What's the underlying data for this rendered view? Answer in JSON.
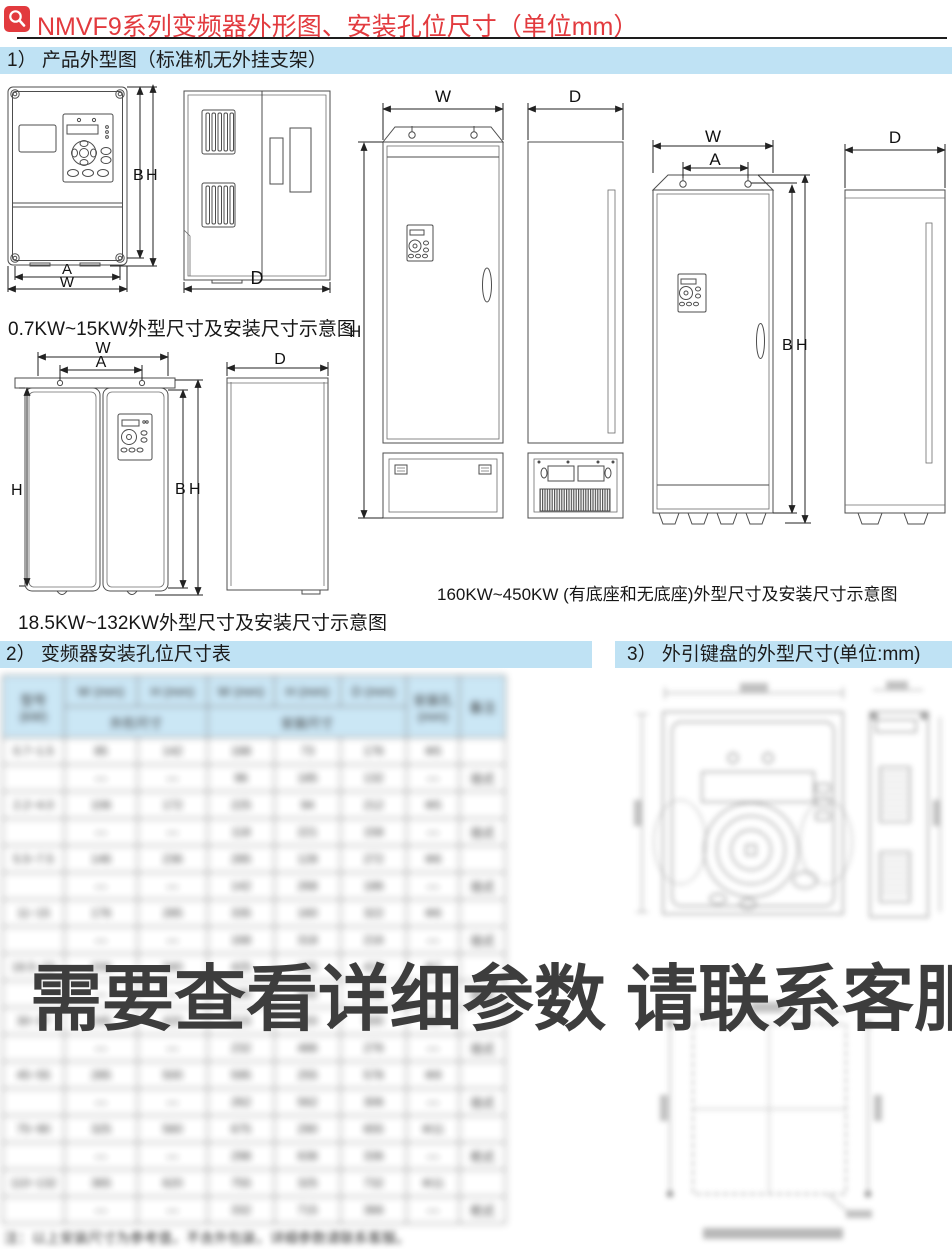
{
  "header": {
    "title": "NMVF9系列变频器外形图、安装孔位尺寸（单位mm）"
  },
  "sections": {
    "s1_heading": "1） 产品外型图（标准机无外挂支架）",
    "s2_heading": "2） 变频器安装孔位尺寸表",
    "s3_heading": "3） 外引键盘的外型尺寸(单位:mm)"
  },
  "captions": {
    "small_range": "0.7KW~15KW外型尺寸及安装尺寸示意图",
    "mid_range": "18.5KW~132KW外型尺寸及安装尺寸示意图",
    "large_range": "160KW~450KW (有底座和无底座)外型尺寸及安装尺寸示意图"
  },
  "dim_labels": {
    "w": "W",
    "a": "A",
    "b": "B",
    "h": "H",
    "d": "D"
  },
  "watermark": {
    "text": "需要查看详细参数 请联系客服"
  },
  "colors": {
    "accent_red": "#e23a3e",
    "banner_blue": "#bfe2f4",
    "table_header_blue": "#c7e5f5"
  },
  "mounting_table": {
    "illegible": true,
    "note": "table content is blurred beyond legibility in the source image; cells below are visual placeholders",
    "header": {
      "model": "型号",
      "model_unit": "(kW)",
      "c2": "W (mm)",
      "c3": "H (mm)",
      "c4": "W (mm)",
      "c5": "H (mm)",
      "c6": "D (mm)",
      "c7": "安装孔(mm)",
      "c8": "备注",
      "group_left": "外形尺寸",
      "group_right": "安装尺寸"
    },
    "placeholder_rows": [
      [
        "0.7~1.5",
        "85",
        "142",
        "188",
        "73",
        "176",
        "Φ5",
        ""
      ],
      [
        "",
        "—",
        "—",
        "96",
        "185",
        "132",
        "—",
        "挂式"
      ],
      [
        "2.2~4.0",
        "106",
        "172",
        "225",
        "94",
        "212",
        "Φ5",
        ""
      ],
      [
        "",
        "—",
        "—",
        "118",
        "221",
        "158",
        "—",
        "挂式"
      ],
      [
        "5.5~7.5",
        "146",
        "236",
        "285",
        "128",
        "272",
        "Φ6",
        ""
      ],
      [
        "",
        "—",
        "—",
        "142",
        "268",
        "186",
        "—",
        "挂式"
      ],
      [
        "11~15",
        "176",
        "285",
        "335",
        "160",
        "322",
        "Φ6",
        ""
      ],
      [
        "",
        "—",
        "—",
        "168",
        "318",
        "216",
        "—",
        "挂式"
      ],
      [
        "18.5~22",
        "206",
        "340",
        "425",
        "185",
        "410",
        "Φ7",
        ""
      ],
      [
        "",
        "—",
        "—",
        "195",
        "402",
        "246",
        "—",
        "挂式"
      ],
      [
        "30~37",
        "245",
        "420",
        "515",
        "220",
        "500",
        "Φ9",
        ""
      ],
      [
        "",
        "—",
        "—",
        "232",
        "486",
        "276",
        "—",
        "挂式"
      ],
      [
        "45~55",
        "285",
        "500",
        "595",
        "255",
        "578",
        "Φ9",
        ""
      ],
      [
        "",
        "—",
        "—",
        "262",
        "562",
        "306",
        "—",
        "挂式"
      ],
      [
        "75~90",
        "325",
        "560",
        "675",
        "290",
        "655",
        "Φ11",
        ""
      ],
      [
        "",
        "—",
        "—",
        "298",
        "638",
        "336",
        "—",
        "柜式"
      ],
      [
        "110~132",
        "365",
        "620",
        "755",
        "325",
        "732",
        "Φ11",
        ""
      ],
      [
        "",
        "—",
        "—",
        "332",
        "715",
        "366",
        "—",
        "柜式"
      ]
    ]
  },
  "footnote": {
    "illegible": true,
    "text": "注：以上安装尺寸为参考值，不含外包装，详细参数请联系客服。"
  }
}
